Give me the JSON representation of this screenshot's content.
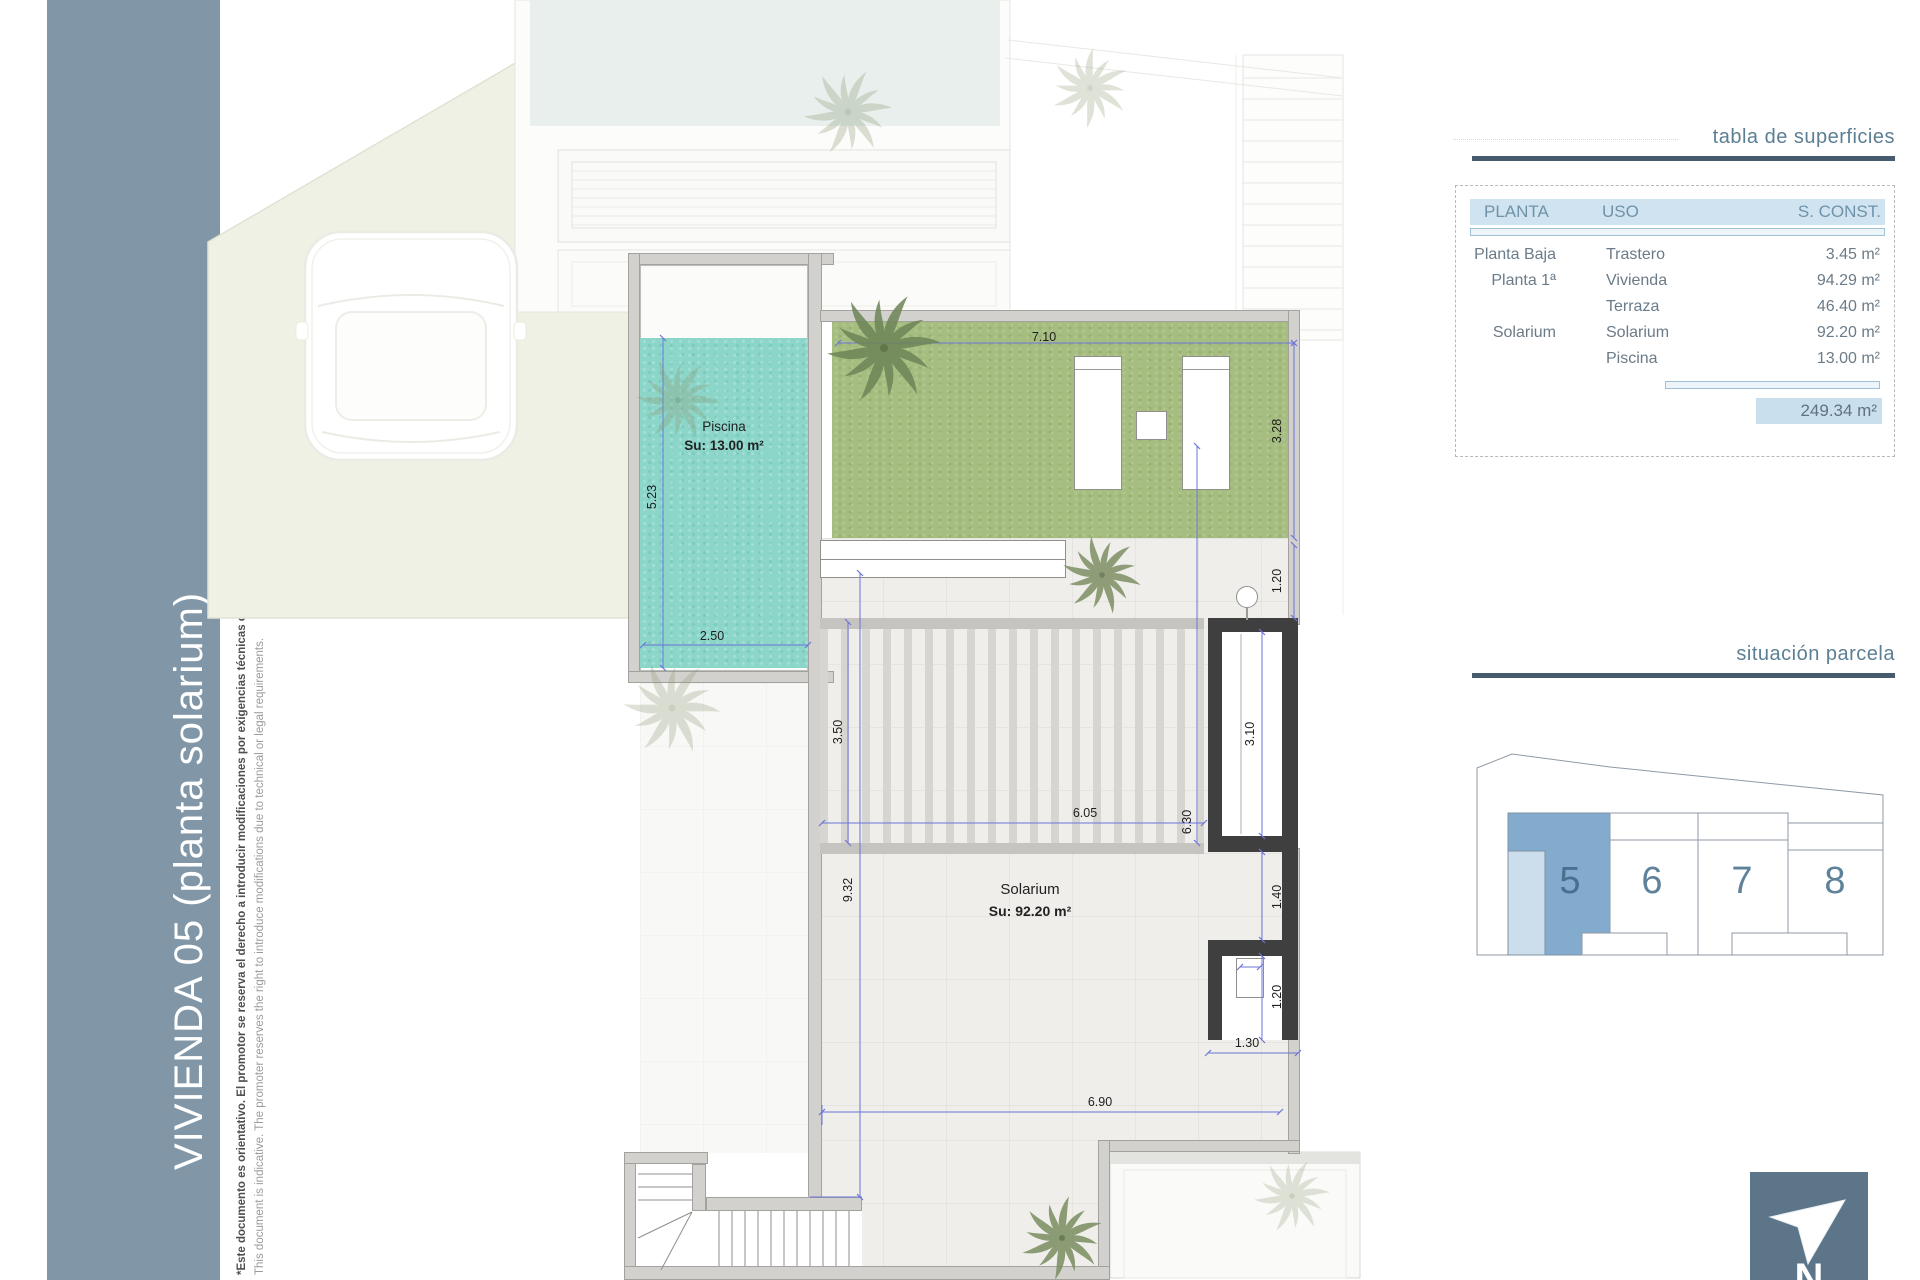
{
  "sidebar": {
    "title": "VIVIENDA 05 (planta solarium)",
    "disclaimer_es": "*Este documento es orientativo. El promotor se reserva el derecho a introducir modificaciones por exigencias técnicas o legales.",
    "disclaimer_en": "This document is indicative. The promoter reserves the right to introduce modifications due to technical or legal requirements."
  },
  "plan": {
    "rooms": {
      "piscina": {
        "name": "Piscina",
        "area": "Su: 13.00 m²"
      },
      "solarium": {
        "name": "Solarium",
        "area": "Su: 92.20 m²"
      }
    },
    "dims": [
      "7.10",
      "3.28",
      "1.20",
      "5.23",
      "2.50",
      "3.50",
      "6.05",
      "6.30",
      "3.10",
      "9.32",
      "1.40",
      "1.20",
      "1.30",
      "6.90"
    ]
  },
  "surfaces": {
    "title": "tabla de superficies",
    "headers": [
      "PLANTA",
      "USO",
      "S. CONST."
    ],
    "rows": [
      {
        "planta": "Planta Baja",
        "uso": "Trastero",
        "sconst": "3.45 m²"
      },
      {
        "planta": "Planta 1ª",
        "uso": "Vivienda",
        "sconst": "94.29 m²"
      },
      {
        "planta": "",
        "uso": "Terraza",
        "sconst": "46.40 m²"
      },
      {
        "planta": "Solarium",
        "uso": "Solarium",
        "sconst": "92.20 m²"
      },
      {
        "planta": "",
        "uso": "Piscina",
        "sconst": "13.00 m²"
      }
    ],
    "total": "249.34 m²"
  },
  "location": {
    "title": "situación parcela",
    "plots": [
      "5",
      "6",
      "7",
      "8"
    ],
    "highlighted": "5"
  },
  "compass": {
    "label": "N"
  },
  "colors": {
    "band": "#8197a8",
    "accent_blue": "#82abcd",
    "accent_blue_light": "#ccdeeb",
    "header_fill": "#cfe3f0",
    "rule": "#475b6e",
    "pool": "#8ad5c8",
    "grass": "#a8bf83",
    "dim_line": "#6b74d8",
    "north_box": "#5c7588"
  }
}
